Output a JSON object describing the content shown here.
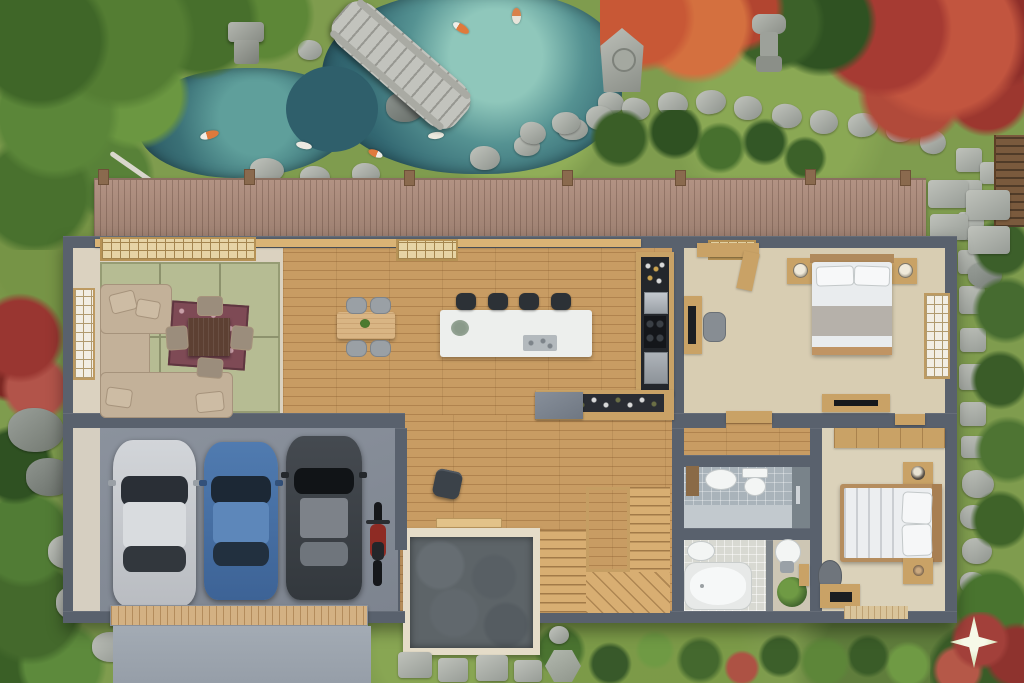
{
  "image_type": "3D architectural floor-plan render, top-down view",
  "setting": "Modern Japanese single-storey house with zen garden, koi pond, engawa deck and 3-car garage",
  "palette": {
    "moss_green": "#7f9c4e",
    "foliage_dark": "#2f5122",
    "foliage_light": "#6b9741",
    "maple_red": "#a63b33",
    "maple_orange": "#d4703f",
    "pond_deep": "#254e5c",
    "pond_shallow": "#7ab5ac",
    "stone_gray": "#a7aba4",
    "deck_wood": "#a8897b",
    "oak_floor": "#c89c63",
    "tatami_green": "#b6bc93",
    "wall_gray": "#59616d",
    "interior_beige": "#dbd2c0",
    "tile_gray": "#a9b3ba",
    "tile_light": "#d8d9d2",
    "counter_dark": "#23262b",
    "slate_entry": "#5d6468",
    "driveway_gray": "#9aa3ac",
    "car_silver": "#c9ccd1",
    "car_blue": "#4a74a8",
    "car_charcoal": "#3c4146",
    "motorcycle_red": "#8e2b24",
    "watermark": "#e9f2da"
  },
  "garden": {
    "features": [
      "koi pond",
      "arched stone bridge",
      "stepping stone paths",
      "stone lanterns",
      "moss ground",
      "red maple trees",
      "evergreen trees",
      "rocks",
      "wood fence section"
    ],
    "koi_count": 6,
    "lantern_count": 3,
    "bridge_material": "stone"
  },
  "deck": {
    "type": "engawa wood deck",
    "posts": 7,
    "side_slabs": "stone"
  },
  "house": {
    "rooms": [
      {
        "name": "living-room",
        "floor": "tatami",
        "contents": [
          "l-shaped-sofa",
          "low-wood-table",
          "patterned-rug",
          "floor-cushions-4",
          "shoji-screen",
          "lattice-panels"
        ]
      },
      {
        "name": "dining-area",
        "floor": "oak",
        "contents": [
          "dining-table",
          "chairs-4",
          "small-plant"
        ]
      },
      {
        "name": "kitchen",
        "floor": "oak",
        "contents": [
          "white-island",
          "bar-stools-4",
          "tall-dark-counter",
          "cooktop",
          "oven",
          "wine-bottle-counter",
          "gray-cabinet"
        ]
      },
      {
        "name": "bedroom-1",
        "floor": "beige",
        "contents": [
          "double-bed",
          "nightstands-2",
          "lamps-2",
          "desk",
          "monitor",
          "chair",
          "wardrobe",
          "media-console",
          "shoji-window",
          "door"
        ]
      },
      {
        "name": "hallway",
        "floor": "oak",
        "contents": [
          "u-shaped-staircase",
          "ottoman"
        ]
      },
      {
        "name": "entry-genkan",
        "floor": "slate-flagstone",
        "contents": [
          "steps",
          "porch"
        ]
      },
      {
        "name": "bathroom-1",
        "floor": "gray-tile",
        "contents": [
          "sink",
          "toilet",
          "shower"
        ]
      },
      {
        "name": "bathroom-2",
        "floor": "light-tile",
        "contents": [
          "sink",
          "bathtub"
        ]
      },
      {
        "name": "powder-room",
        "contents": [
          "round-basin",
          "plant",
          "wall-frame"
        ]
      },
      {
        "name": "bedroom-2",
        "floor": "beige",
        "contents": [
          "double-bed",
          "nightstands-2",
          "wardrobe",
          "desk",
          "laptop",
          "chair",
          "floor-mat"
        ]
      }
    ]
  },
  "garage": {
    "vehicles": [
      {
        "type": "car",
        "color_name": "silver"
      },
      {
        "type": "car",
        "color_name": "blue"
      },
      {
        "type": "car",
        "color_name": "charcoal"
      },
      {
        "type": "motorcycle",
        "color_name": "red"
      }
    ],
    "door": "wood-panel-garage-door",
    "driveway": "concrete"
  },
  "watermark": {
    "shape": "four-pointed-star",
    "position": "bottom-right"
  }
}
